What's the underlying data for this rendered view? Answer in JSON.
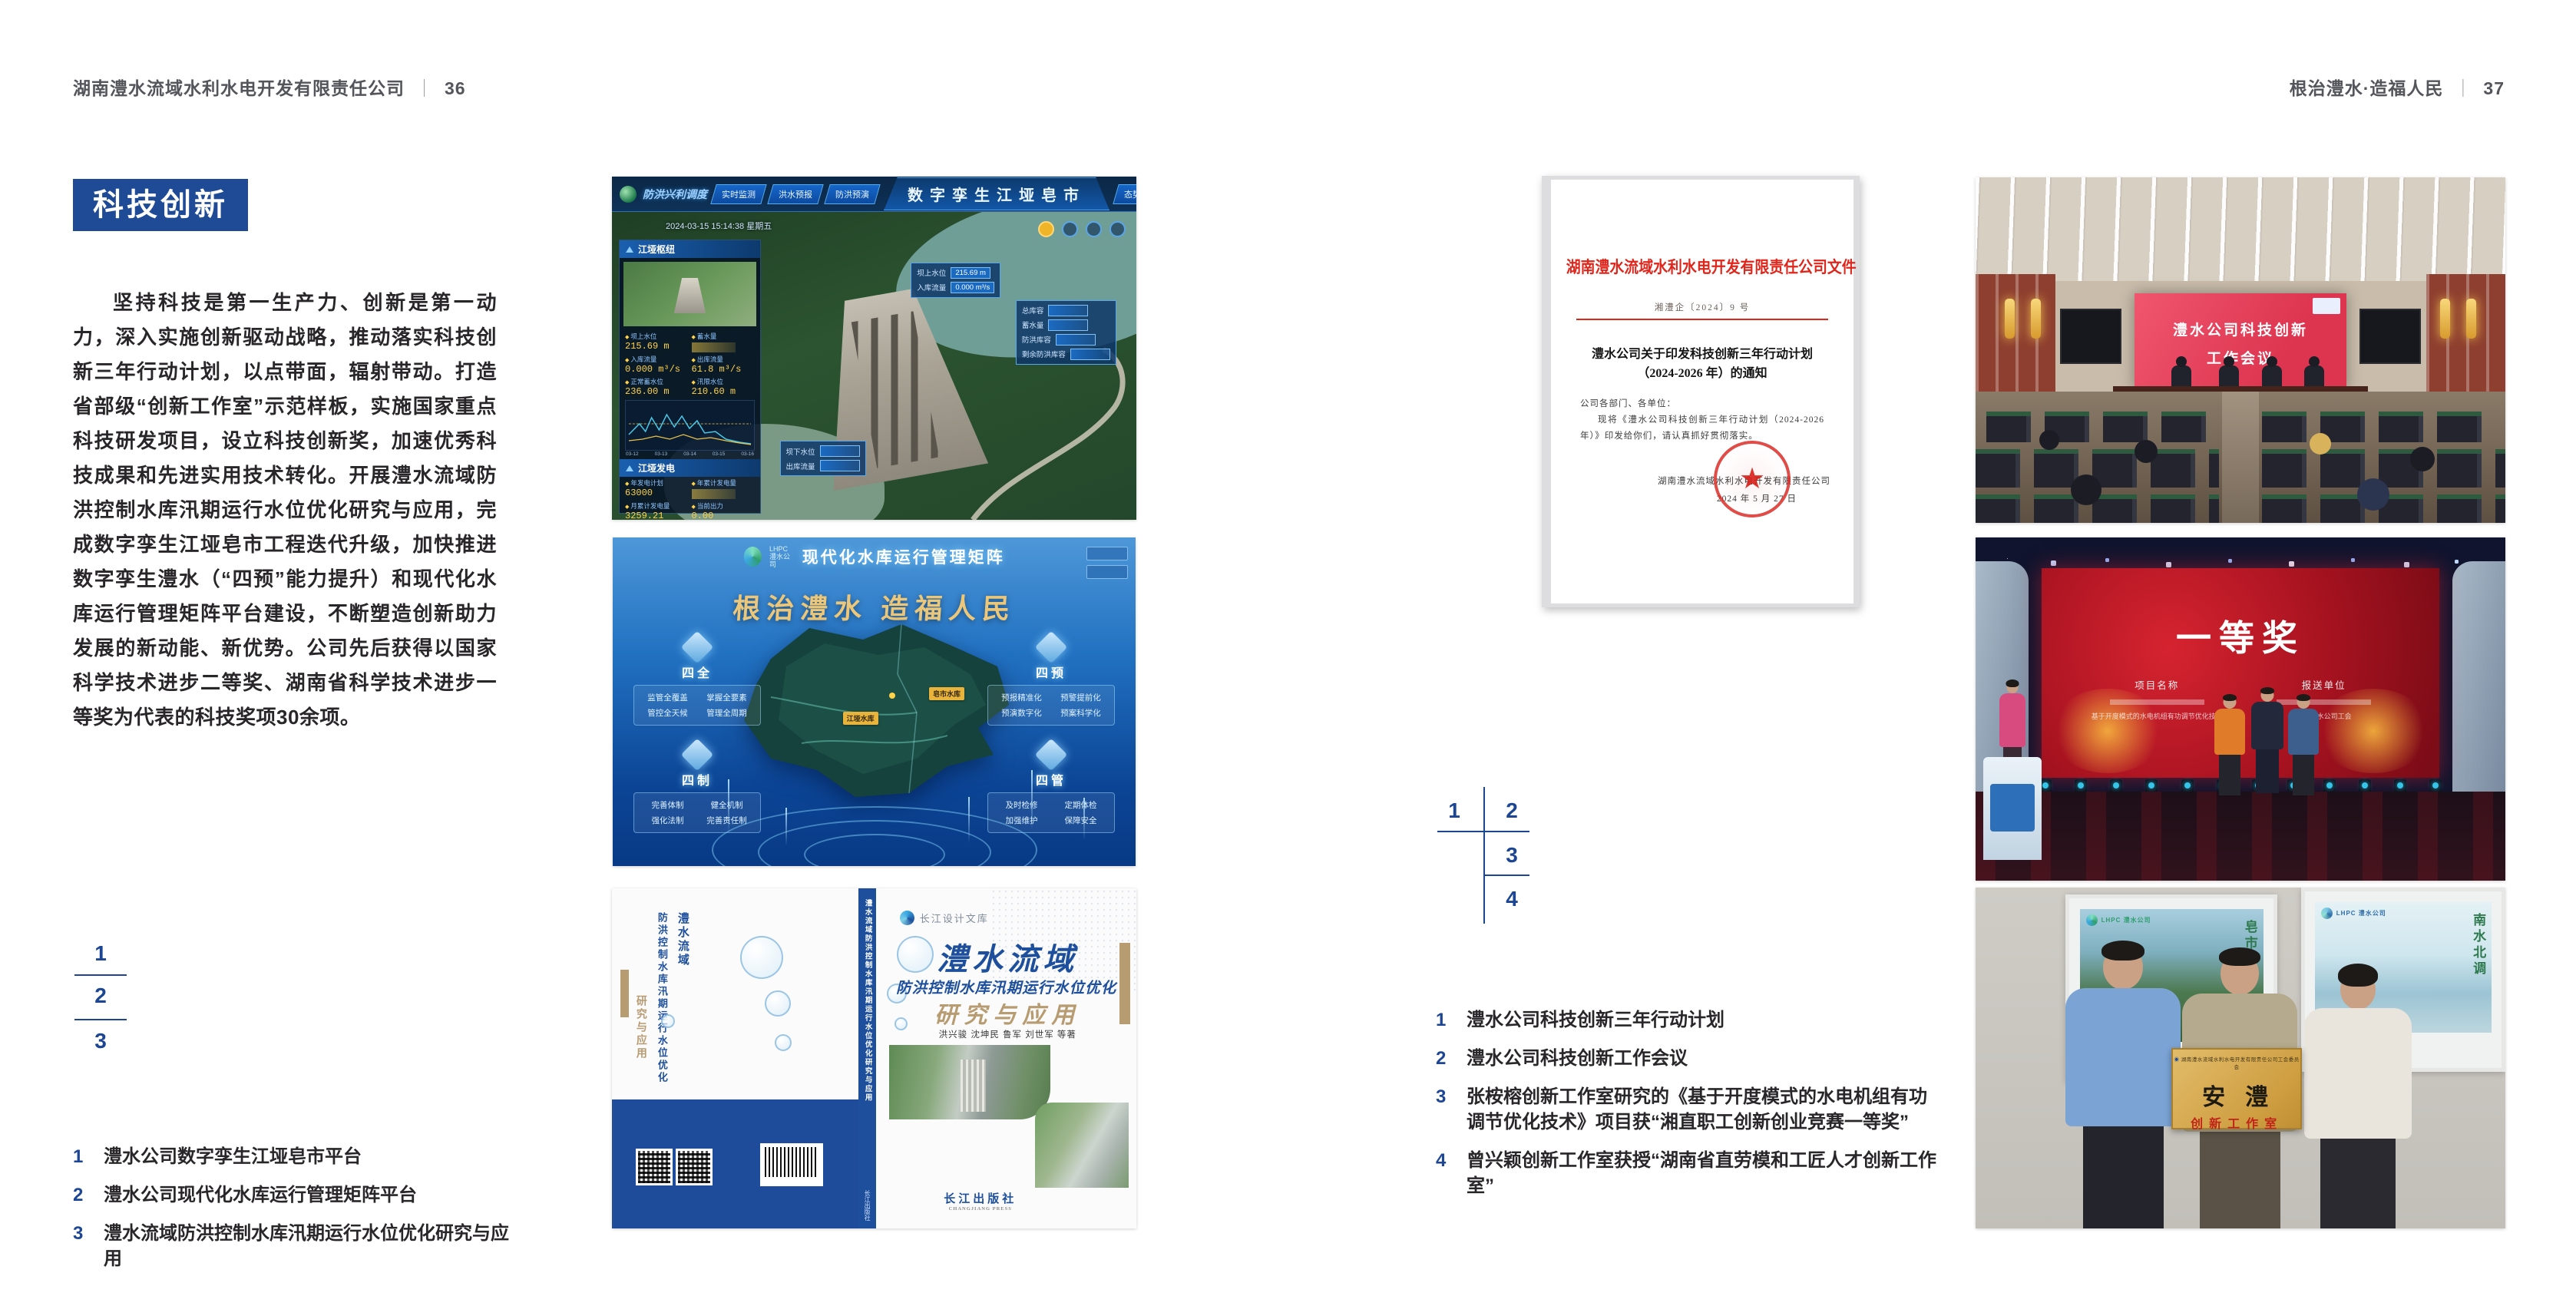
{
  "left_page": {
    "header_company": "湖南澧水流域水利水电开发有限责任公司",
    "header_sep": "｜",
    "header_page": "36",
    "badge": "科技创新",
    "paragraph": "坚持科技是第一生产力、创新是第一动力，深入实施创新驱动战略，推动落实科技创新三年行动计划，以点带面，辐射带动。打造省部级“创新工作室”示范样板，实施国家重点科技研发项目，设立科技创新奖，加速优秀科技成果和先进实用技术转化。开展澧水流域防洪控制水库汛期运行水位优化研究与应用，完成数字孪生江垭皂市工程迭代升级，加快推进数字孪生澧水（“四预”能力提升）和现代化水库运行管理矩阵平台建设，不断塑造创新助力发展的新动能、新优势。公司先后获得以国家科学技术进步二等奖、湖南省科学技术进步一等奖为代表的科技奖项30余项。",
    "figure_index": {
      "n1": "1",
      "n2": "2",
      "n3": "3"
    },
    "captions": [
      {
        "num": "1",
        "text": "澧水公司数字孪生江垭皂市平台"
      },
      {
        "num": "2",
        "text": "澧水公司现代化水库运行管理矩阵平台"
      },
      {
        "num": "3",
        "text": "澧水流域防洪控制水库汛期运行水位优化研究与应用"
      }
    ]
  },
  "right_page": {
    "header_title": "根治澧水·造福人民",
    "header_sep": "｜",
    "header_page": "37",
    "figure_index": {
      "n1": "1",
      "n2": "2",
      "n3": "3",
      "n4": "4"
    },
    "captions": [
      {
        "num": "1",
        "text": "澧水公司科技创新三年行动计划"
      },
      {
        "num": "2",
        "text": "澧水公司科技创新工作会议"
      },
      {
        "num": "3",
        "text": "张桉榕创新工作室研究的《基于开度模式的水电机组有功调节优化技术》项目获“湘直职工创新创业竞赛一等奖”"
      },
      {
        "num": "4",
        "text": "曾兴颖创新工作室获授“湖南省直劳模和工匠人才创新工作室”"
      }
    ]
  },
  "dashboard": {
    "title": "数字孪生江垭皂市",
    "corner_label": "防洪兴利调度",
    "tabs_left": [
      "实时监测",
      "洪水预报",
      "防洪预演"
    ],
    "tabs_right": [
      "态势预测",
      "预案生成",
      "调度执行",
      "工程导览"
    ],
    "timestamp": "2024-03-15 15:14:38 星期五",
    "panel1_title": "江垭枢纽",
    "panel2_title": "江垭发电",
    "stats1": [
      {
        "label": "坝上水位",
        "value": "215.69 m"
      },
      {
        "label": "蓄水量",
        "value": ""
      },
      {
        "label": "入库流量",
        "value": "0.000 m³/s"
      },
      {
        "label": "出库流量",
        "value": "61.8 m³/s"
      },
      {
        "label": "正常蓄水位",
        "value": "236.00 m"
      },
      {
        "label": "汛限水位",
        "value": "210.60 m"
      }
    ],
    "stats2": [
      {
        "label": "年发电计划",
        "value": "63000"
      },
      {
        "label": "年累计发电量",
        "value": ""
      },
      {
        "label": "月累计发电量",
        "value": "3259.21"
      },
      {
        "label": "当前出力",
        "value": "0.00"
      },
      {
        "label": "发电流量",
        "value": "0.00"
      },
      {
        "label": "弃水流量",
        "value": "0.00"
      }
    ],
    "chart_dates": [
      "03-12",
      "03-13",
      "03-14",
      "03-15",
      "03-16"
    ],
    "callout1": [
      {
        "label": "坝上水位",
        "value": "215.69 m"
      },
      {
        "label": "入库流量",
        "value": "0.000 m³/s"
      }
    ],
    "callout2": [
      {
        "label": "总库容",
        "value": ""
      },
      {
        "label": "蓄水量",
        "value": ""
      },
      {
        "label": "防洪库容",
        "value": ""
      },
      {
        "label": "剩余防洪库容",
        "value": ""
      }
    ],
    "callout3": [
      {
        "label": "坝下水位",
        "value": ""
      },
      {
        "label": "出库流量",
        "value": ""
      }
    ]
  },
  "platform": {
    "logo_text": "LHPC\n澧水公司",
    "title": "现代化水库运行管理矩阵",
    "slogan": "根治澧水  造福人民",
    "map_labels": [
      "皂市水库",
      "江垭水库"
    ],
    "groups": [
      {
        "name": "四全",
        "items": [
          "监管全覆盖",
          "掌握全要素",
          "管控全天候",
          "管理全周期"
        ]
      },
      {
        "name": "四预",
        "items": [
          "预报精准化",
          "预警提前化",
          "预演数字化",
          "预案科学化"
        ]
      },
      {
        "name": "四制",
        "items": [
          "完善体制",
          "健全机制",
          "强化法制",
          "完善责任制"
        ]
      },
      {
        "name": "四管",
        "items": [
          "及时检修",
          "定期体检",
          "加强维护",
          "保障安全"
        ]
      }
    ]
  },
  "book": {
    "series": "长江设计文库",
    "title_main": "澧水流域",
    "title_sub": "防洪控制水库汛期运行水位优化",
    "title_tail": "研究与应用",
    "authors": "洪兴骏  沈坤民  鲁军  刘世军  等著",
    "publisher": "长江出版社",
    "publisher_en": "CHANGJIANG PRESS",
    "spine_text": "澧水流域防洪控制水库汛期运行水位优化研究与应用",
    "spine_pub": "长江出版社",
    "back_title_1": "澧水流域",
    "back_title_2": "防洪控制水库汛期运行水位优化",
    "back_title_3": "研究与应用"
  },
  "document": {
    "header": "湖南澧水流域水利水电开发有限责任公司文件",
    "doc_no": "湘澧企〔2024〕9 号",
    "title_line1": "澧水公司关于印发科技创新三年行动计划",
    "title_line2": "（2024-2026 年）的通知",
    "salutation": "公司各部门、各单位：",
    "body": "现将《澧水公司科技创新三年行动计划（2024-2026 年）》印发给你们，请认真抓好贯彻落实。",
    "sign_company": "湖南澧水流域水利水电开发有限责任公司",
    "sign_date": "2024 年 5 月 27 日",
    "seal_star": "★"
  },
  "meeting_photo": {
    "screen_line1": "澧水公司科技创新",
    "screen_line2": "工作会议"
  },
  "award_photo": {
    "award_title": "一等奖",
    "col1_heading": "项目名称",
    "col2_heading": "报送单位",
    "col1_text": "基于开度模式的水电机组有功调节优化技术",
    "col2_text": "湖南澧水公司工会"
  },
  "plaque_photo": {
    "poster_left_logo": "LHPC 澧水公司",
    "poster_left_cal": "皂市水库",
    "poster_right_logo": "LHPC 澧水公司",
    "poster_right_cal": "南水北调",
    "plaque_company": "湖南澧水流域水利水电开发有限责任公司工会委员会",
    "plaque_main": "安澧",
    "plaque_sub": "创新工作室"
  },
  "colors": {
    "accent_blue": "#1e4a96",
    "index_blue": "#1c4693",
    "doc_red": "#e0251b",
    "book_blue": "#1d4f9c",
    "book_tan": "#b79b71"
  }
}
